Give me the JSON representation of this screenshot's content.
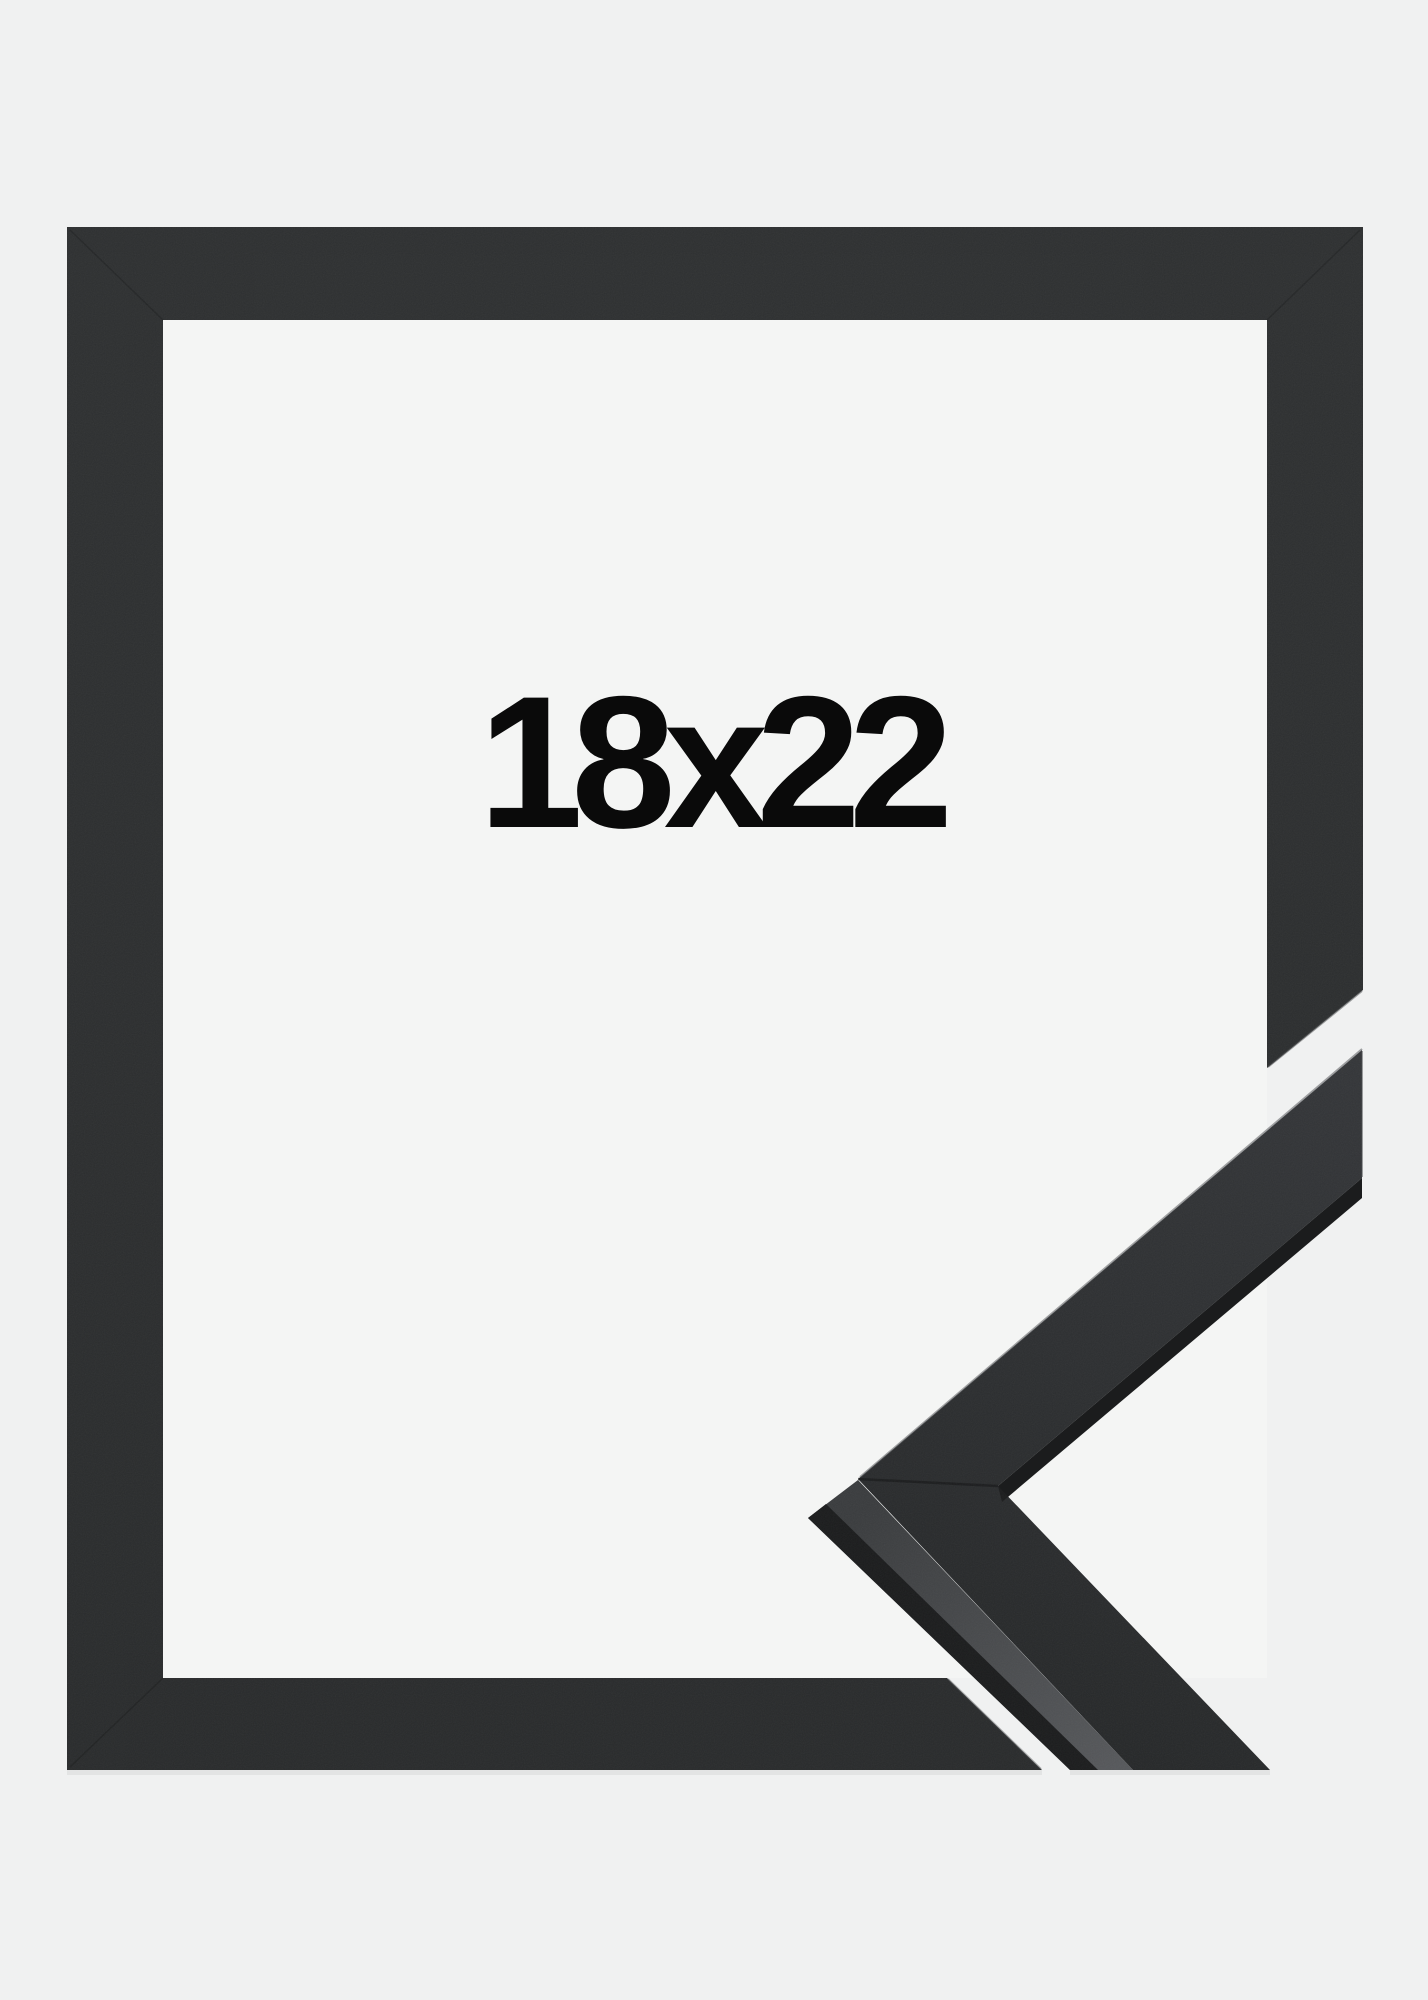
{
  "product": {
    "size_label": "18x22"
  },
  "colors": {
    "background": "#f0f1f1",
    "opening": "#f4f5f4",
    "frame_front": "#2c2e2f",
    "sample_front_light": "#343639",
    "sample_front_dark": "#262829",
    "sample_side_light": "#56585b",
    "sample_side_dark": "#3a3c3e",
    "sample_edge": "#1b1c1d",
    "label_text": "#0a0a0a"
  }
}
